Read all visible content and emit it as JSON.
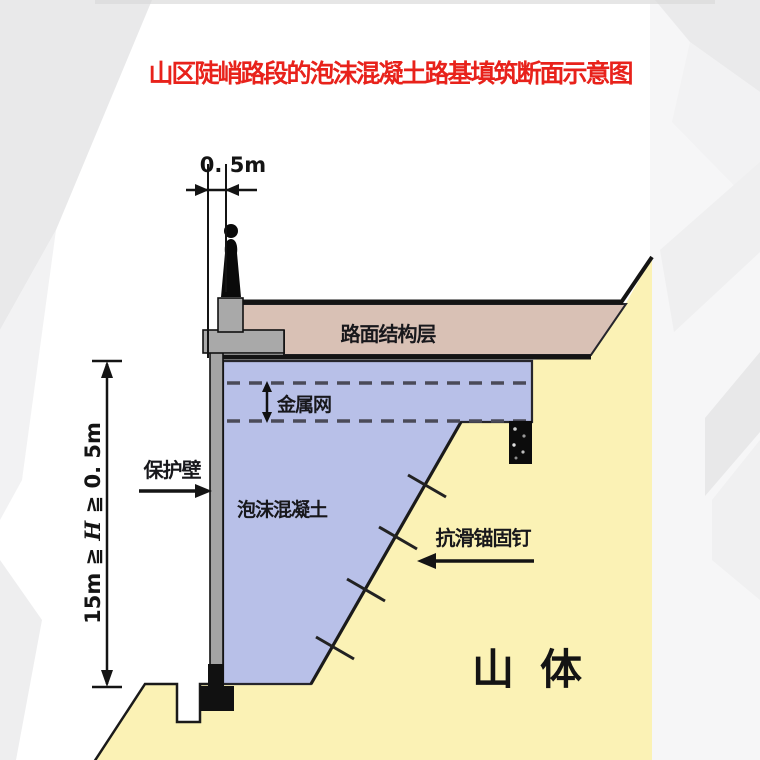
{
  "title": "山区陡峭路段的泡沫混凝土路基填筑断面示意图",
  "dimensions": {
    "top_width": "0. 5m",
    "fill_height_prefix": "15m ≧ ",
    "fill_height_variable": "H",
    "fill_height_suffix": " ≧ 0. 5m"
  },
  "labels": {
    "pavement_layer": "路面结构层",
    "metal_mesh": "金属网",
    "protection_wall": "保护壁",
    "foam_concrete": "泡沫混凝土",
    "anchor_nail": "抗滑锚固钉",
    "mountain_body": "山体"
  },
  "colors": {
    "title": "#e8221b",
    "pavement": "#d9c1b5",
    "foam_concrete": "#b8c0e8",
    "mountain": "#fbf2b5",
    "wall": "#a4a4a4",
    "outline": "#1a1a1a"
  }
}
